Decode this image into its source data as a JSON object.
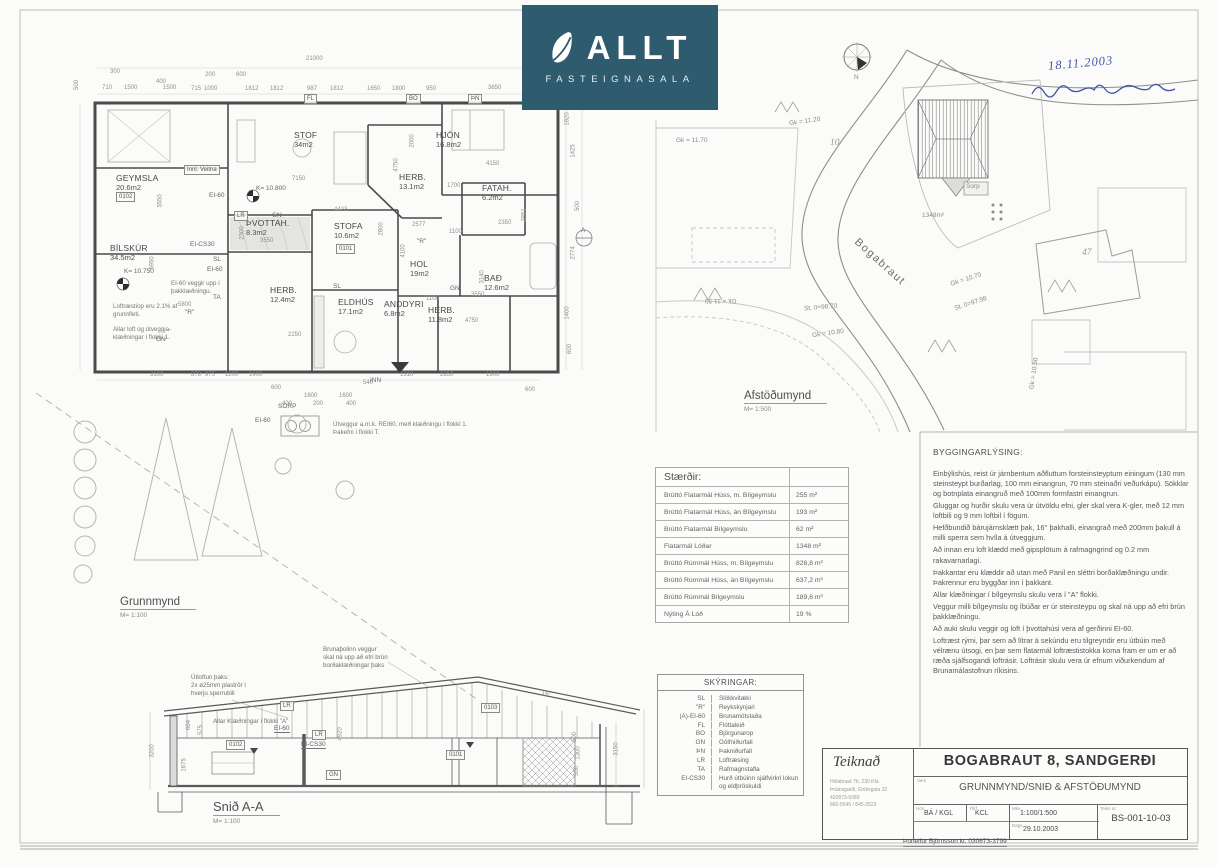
{
  "logo": {
    "brand": "ALLT",
    "subtitle": "FASTEIGNASALA",
    "bg_color": "#2e5b6d",
    "icon": "leaf-icon"
  },
  "handwriting": {
    "date": "18.11.2003",
    "ink_color": "#4356a6"
  },
  "views": {
    "plan": {
      "label": "Grunnmynd",
      "scale": "M= 1:100"
    },
    "site": {
      "label": "Afstöðumynd",
      "scale": "M= 1:500"
    },
    "section": {
      "label": "Snið A-A",
      "scale": "M= 1:100"
    }
  },
  "floor_plan": {
    "rooms": [
      {
        "name": "GEYMSLA",
        "area": "20.6m2",
        "x": 116,
        "y": 174
      },
      {
        "name": "BÍLSKÚR",
        "area": "34.5m2",
        "x": 110,
        "y": 244
      },
      {
        "name": "STOF",
        "area": "34m2",
        "x": 294,
        "y": 131
      },
      {
        "name": "HJÓN",
        "area": "16.8m2",
        "x": 436,
        "y": 131
      },
      {
        "name": "HERB.",
        "area": "13.1m2",
        "x": 399,
        "y": 173
      },
      {
        "name": "FATAH.",
        "area": "6.2m2",
        "x": 482,
        "y": 184
      },
      {
        "name": "STOFA",
        "area": "10.6m2",
        "x": 334,
        "y": 222
      },
      {
        "name": "HOL",
        "area": "19m2",
        "x": 410,
        "y": 260
      },
      {
        "name": "BAÐ",
        "area": "12.6m2",
        "x": 484,
        "y": 274
      },
      {
        "name": "HERB.",
        "area": "12.4m2",
        "x": 270,
        "y": 286
      },
      {
        "name": "ELDHÚS",
        "area": "17.1m2",
        "x": 338,
        "y": 298
      },
      {
        "name": "ANDDYRI",
        "area": "6.8m2",
        "x": 384,
        "y": 300
      },
      {
        "name": "HERB.",
        "area": "11.8m2",
        "x": 428,
        "y": 306
      },
      {
        "name": "ÞVOTTAH.",
        "area": "8.3m2",
        "x": 246,
        "y": 219
      }
    ],
    "dims": [
      {
        "t": "21000",
        "x": 306,
        "y": 56
      },
      {
        "t": "300",
        "x": 110,
        "y": 69
      },
      {
        "t": "400",
        "x": 156,
        "y": 79
      },
      {
        "t": "200",
        "x": 205,
        "y": 72
      },
      {
        "t": "600",
        "x": 236,
        "y": 72
      },
      {
        "t": "710",
        "x": 102,
        "y": 85
      },
      {
        "t": "1500",
        "x": 124,
        "y": 85
      },
      {
        "t": "1500",
        "x": 163,
        "y": 85
      },
      {
        "t": "715",
        "x": 191,
        "y": 86
      },
      {
        "t": "1000",
        "x": 204,
        "y": 86
      },
      {
        "t": "1812",
        "x": 245,
        "y": 86
      },
      {
        "t": "1812",
        "x": 270,
        "y": 86
      },
      {
        "t": "987",
        "x": 307,
        "y": 86
      },
      {
        "t": "1812",
        "x": 330,
        "y": 86
      },
      {
        "t": "1650",
        "x": 367,
        "y": 86
      },
      {
        "t": "1800",
        "x": 392,
        "y": 86
      },
      {
        "t": "950",
        "x": 426,
        "y": 86
      },
      {
        "t": "3650",
        "x": 488,
        "y": 85
      },
      {
        "t": "500",
        "x": 72,
        "y": 82,
        "r": -90
      },
      {
        "t": "3550",
        "x": 154,
        "y": 198,
        "r": -90
      },
      {
        "t": "5950",
        "x": 146,
        "y": 260,
        "r": -90
      },
      {
        "t": "7150",
        "x": 292,
        "y": 176
      },
      {
        "t": "4423",
        "x": 334,
        "y": 207
      },
      {
        "t": "2000",
        "x": 406,
        "y": 138,
        "r": -90
      },
      {
        "t": "4750",
        "x": 390,
        "y": 162,
        "r": -90
      },
      {
        "t": "4150",
        "x": 486,
        "y": 161
      },
      {
        "t": "1700",
        "x": 447,
        "y": 183
      },
      {
        "t": "2350",
        "x": 498,
        "y": 220
      },
      {
        "t": "2851",
        "x": 518,
        "y": 212,
        "r": -90
      },
      {
        "t": "2577",
        "x": 412,
        "y": 222
      },
      {
        "t": "1100",
        "x": 449,
        "y": 229
      },
      {
        "t": "2800",
        "x": 375,
        "y": 226,
        "r": -90
      },
      {
        "t": "4100",
        "x": 397,
        "y": 248,
        "r": -90
      },
      {
        "t": "3140",
        "x": 476,
        "y": 274,
        "r": -90
      },
      {
        "t": "3550",
        "x": 471,
        "y": 292
      },
      {
        "t": "1100",
        "x": 426,
        "y": 296
      },
      {
        "t": "4750",
        "x": 465,
        "y": 318
      },
      {
        "t": "2250",
        "x": 288,
        "y": 332
      },
      {
        "t": "2300",
        "x": 236,
        "y": 230,
        "r": -90
      },
      {
        "t": "3550",
        "x": 260,
        "y": 238
      },
      {
        "t": "5800",
        "x": 178,
        "y": 302
      },
      {
        "t": "3100",
        "x": 150,
        "y": 372
      },
      {
        "t": "878",
        "x": 191,
        "y": 372
      },
      {
        "t": "975",
        "x": 205,
        "y": 372
      },
      {
        "t": "1200",
        "x": 225,
        "y": 372
      },
      {
        "t": "1900",
        "x": 249,
        "y": 372
      },
      {
        "t": "600",
        "x": 271,
        "y": 385
      },
      {
        "t": "540",
        "x": 363,
        "y": 380
      },
      {
        "t": "1310",
        "x": 400,
        "y": 372
      },
      {
        "t": "2850",
        "x": 440,
        "y": 372
      },
      {
        "t": "1900",
        "x": 486,
        "y": 372
      },
      {
        "t": "600",
        "x": 525,
        "y": 387
      },
      {
        "t": "400",
        "x": 282,
        "y": 401
      },
      {
        "t": "1600",
        "x": 304,
        "y": 393
      },
      {
        "t": "1600",
        "x": 339,
        "y": 393
      },
      {
        "t": "200",
        "x": 313,
        "y": 401
      },
      {
        "t": "400",
        "x": 346,
        "y": 401
      },
      {
        "t": "1820",
        "x": 561,
        "y": 116,
        "r": -90
      },
      {
        "t": "1425",
        "x": 567,
        "y": 148,
        "r": -90
      },
      {
        "t": "500",
        "x": 573,
        "y": 203,
        "r": -90
      },
      {
        "t": "2774",
        "x": 567,
        "y": 250,
        "r": -90
      },
      {
        "t": "1400",
        "x": 561,
        "y": 310,
        "r": -90
      },
      {
        "t": "600",
        "x": 565,
        "y": 346,
        "r": -90
      }
    ],
    "codes": [
      {
        "t": "EI-60",
        "x": 209,
        "y": 192
      },
      {
        "t": "K= 10.800",
        "x": 256,
        "y": 185
      },
      {
        "t": "K= 10.750",
        "x": 124,
        "y": 268
      },
      {
        "t": "EI-CS30",
        "x": 190,
        "y": 241
      },
      {
        "t": "SL",
        "x": 213,
        "y": 256
      },
      {
        "t": "EI-60",
        "x": 207,
        "y": 266
      },
      {
        "t": "TA",
        "x": 213,
        "y": 294
      },
      {
        "t": "\"R\"",
        "x": 185,
        "y": 309
      },
      {
        "t": "\"R\"",
        "x": 417,
        "y": 238
      },
      {
        "t": "GN",
        "x": 272,
        "y": 212
      },
      {
        "t": "GN",
        "x": 450,
        "y": 285
      },
      {
        "t": "GN",
        "x": 156,
        "y": 336
      },
      {
        "t": "SL",
        "x": 333,
        "y": 283
      },
      {
        "t": "SORP",
        "x": 278,
        "y": 403
      },
      {
        "t": "EI-60",
        "x": 255,
        "y": 417
      },
      {
        "t": "INN",
        "x": 370,
        "y": 377
      },
      {
        "t": "A",
        "x": 581,
        "y": 227
      }
    ],
    "chips": [
      {
        "t": "Innl. Veitna",
        "x": 184,
        "y": 165
      },
      {
        "t": "LR",
        "x": 234,
        "y": 211
      },
      {
        "t": "0102",
        "x": 116,
        "y": 192
      },
      {
        "t": "0101",
        "x": 336,
        "y": 244
      },
      {
        "t": "FL",
        "x": 304,
        "y": 94
      },
      {
        "t": "BO",
        "x": 406,
        "y": 94
      },
      {
        "t": "ÞN",
        "x": 468,
        "y": 94
      }
    ],
    "notes": [
      {
        "t": "EI-60 veggir upp í\nþakklæðningu.",
        "x": 171,
        "y": 280
      },
      {
        "t": "Loftræstiop eru 2.1% af\ngrunnfleti.",
        "x": 113,
        "y": 303
      },
      {
        "t": "Allar loft og útveggja-\nklæðningar í flokki 1.",
        "x": 113,
        "y": 326
      },
      {
        "t": "Útveggur a.m.k. REI60, með klæðningu í flokki 1.\nÞakefni í flokki T.",
        "x": 333,
        "y": 421
      }
    ]
  },
  "site_plan": {
    "street": "Bogabraut",
    "labels": [
      {
        "t": "Gk = 11.70",
        "x": 676,
        "y": 137
      },
      {
        "t": "Gk = 11.20",
        "x": 789,
        "y": 118,
        "r": -8
      },
      {
        "t": "Gk = 11.30",
        "x": 705,
        "y": 297,
        "r": 180
      },
      {
        "t": "St. 0=98.70",
        "x": 804,
        "y": 304,
        "r": -5
      },
      {
        "t": "Gk = 10.80",
        "x": 812,
        "y": 330,
        "r": -8
      },
      {
        "t": "Sorp",
        "x": 966,
        "y": 183
      },
      {
        "t": "1348m²",
        "x": 922,
        "y": 212
      },
      {
        "t": "Gk = 10.70",
        "x": 950,
        "y": 276,
        "r": -18
      },
      {
        "t": "St. 0=97.98",
        "x": 954,
        "y": 300,
        "r": -18
      },
      {
        "t": "Gk = 10.50",
        "x": 1018,
        "y": 370,
        "r": -82
      },
      {
        "t": "N",
        "x": 854,
        "y": 74
      }
    ],
    "plot_numbers": [
      {
        "t": "10",
        "x": 830,
        "y": 138
      },
      {
        "t": "47",
        "x": 1082,
        "y": 248
      }
    ]
  },
  "section": {
    "dims": [
      {
        "t": "3200",
        "x": 146,
        "y": 748,
        "r": -90
      },
      {
        "t": "664",
        "x": 184,
        "y": 722,
        "r": -90
      },
      {
        "t": "575",
        "x": 196,
        "y": 727,
        "r": -90
      },
      {
        "t": "1675",
        "x": 178,
        "y": 762,
        "r": -90
      },
      {
        "t": "4920",
        "x": 334,
        "y": 731,
        "r": -90
      },
      {
        "t": "500",
        "x": 570,
        "y": 734,
        "r": -90
      },
      {
        "t": "1300",
        "x": 572,
        "y": 750,
        "r": -90
      },
      {
        "t": "500",
        "x": 572,
        "y": 768,
        "r": -90
      },
      {
        "t": "3150",
        "x": 610,
        "y": 746,
        "r": -90
      },
      {
        "t": "16°",
        "x": 542,
        "y": 692
      }
    ],
    "chips": [
      {
        "t": "LR",
        "x": 280,
        "y": 701
      },
      {
        "t": "LR",
        "x": 312,
        "y": 730
      },
      {
        "t": "GN",
        "x": 326,
        "y": 770
      },
      {
        "t": "0102",
        "x": 226,
        "y": 740
      },
      {
        "t": "0101",
        "x": 446,
        "y": 750
      },
      {
        "t": "0103",
        "x": 481,
        "y": 703
      }
    ],
    "underlined": [
      {
        "t": "EI-60",
        "x": 274,
        "y": 725
      },
      {
        "t": "EI-CS30",
        "x": 301,
        "y": 741
      }
    ],
    "notes": [
      {
        "t": "Útloftun þaks:\n2x ø25mm plaströr í\nhverju sperrubili",
        "x": 191,
        "y": 674
      },
      {
        "t": "Brunaþolinn veggur\nskal ná upp að efri brún\nborðaklæðningar þaks",
        "x": 323,
        "y": 646
      },
      {
        "t": "Allar Klæðningar í flokki \"A\"",
        "x": 213,
        "y": 718
      }
    ]
  },
  "size_table": {
    "title": "Stærðir:",
    "rows": [
      {
        "label": "Brúttó Flatarmál Húss, m. Bílgeymslu",
        "value": "255 m²"
      },
      {
        "label": "Brúttó Flatarmál Húss, án Bílgeymslu",
        "value": "193 m²"
      },
      {
        "label": "Brúttó Flatarmál Bílgeymslu",
        "value": "62 m²"
      },
      {
        "label": "Flatarmál Lóðar",
        "value": "1348 m²"
      },
      {
        "label": "Brúttó Rúmmál Húss, m. Bílgeymslu",
        "value": "826,8 m³"
      },
      {
        "label": "Brúttó Rúmmál Húss, án Bílgeymslu",
        "value": "637,2 m³"
      },
      {
        "label": "Brúttó Rúmmál Bílgeymslu",
        "value": "189,6 m³"
      },
      {
        "label": "Nýting Á Lóð",
        "value": "19 %"
      }
    ]
  },
  "legend": {
    "title": "SKÝRINGAR:",
    "rows": [
      {
        "code": "SL",
        "meaning": "Slökkvitæki"
      },
      {
        "code": "\"R\"",
        "meaning": "Reykskynjari"
      },
      {
        "code": "(A)-EI-60",
        "meaning": "Brunamótstaða"
      },
      {
        "code": "FL",
        "meaning": "Flóttaleið"
      },
      {
        "code": "BO",
        "meaning": "Björgunarop"
      },
      {
        "code": "GN",
        "meaning": "Gólfniðurfall"
      },
      {
        "code": "ÞN",
        "meaning": "Þakniðurfall"
      },
      {
        "code": "LR",
        "meaning": "Loftræsing"
      },
      {
        "code": "TA",
        "meaning": "Rafmagnstafla"
      },
      {
        "code": "EI-CS30",
        "meaning": "Hurð útbúinn sjálfvirkri lokun og eldþröskuldi"
      }
    ]
  },
  "description": {
    "title": "BYGGINGARLÝSING:",
    "paragraphs": [
      {
        "t": "Einbýlishús, reist úr járnbentum aðfluttum forsteinsteyptum einingum (130 mm steinsteypt burðarlag, 100 mm einangrun, 70 mm steinaðri veðurkápu).  Sökklar og botnplata einangruð með 100mm formfastri einangrun."
      },
      {
        "t": "Gluggar og hurðir skulu vera úr útvöldu efni, gler skal vera K-gler, með 12 mm loftbili og 9 mm loftbil í fögum."
      },
      {
        "t": "Hefðbundið bárujárnsklætt þak, 16° þakhalli, einangrað með 200mm þakull á milli sperra sem hvíla á útveggjum."
      },
      {
        "t": "Að innan eru loft klædd með gipsplötum á rafmagngrind og 0.2 mm rakavarnarlagi."
      },
      {
        "t": "Þakkantar eru klæddir að utan með Panil en sléttri borðaklæðningu undir. Þakrennur eru byggðar inn í þakkant."
      },
      {
        "t": "Allar klæðningar í bílgeymslu skulu vera í \"A\" flokki."
      },
      {
        "t": "Veggur milli bílgeymslu og íbúðar er úr steinsteypu og skal ná upp að efri brún þakklæðningu."
      },
      {
        "t": "Að auki skulu veggir og loft í þvottahúsi vera af gerðinni EI-60."
      },
      {
        "t": "Loftræst rými, þar sem að lítrar á sekúndu eru tilgreyndir eru útbúin með vélrænu útsogi, en þar sem flatarmál loftræstistokka koma fram er um er að ræða sjálfsogandi loftrásir.  Loftrásir skulu vera úr efnum viðurkendum af Brunamálastofnun ríkisins."
      }
    ]
  },
  "title_block": {
    "drawn_label": "Teiknað",
    "address_lines": [
      {
        "t": "Hólabraut 7b, 230 Kfa"
      },
      {
        "t": "Þráinsgarði, Eiríksgata 32"
      },
      {
        "t": "420873-5089"
      },
      {
        "t": "860-5545 / 845-3523"
      }
    ],
    "verk_label": "Verk",
    "project_title": "BOGABRAUT 8, SANDGERÐI",
    "sheet_title": "GRUNNMYND/SNIÐ & AFSTÖÐUMYND",
    "hon_label": "Hön.",
    "drawn_by": "BÁ / KGL",
    "yfirf_label": "Yfirf.",
    "checked_by": "KCL",
    "mkv_label": "Mkv.",
    "scales": "1:100/1:500",
    "dags_label": "Dags.",
    "date": "29.10.2003",
    "no_label": "Teikn nr.",
    "drawing_no": "BS-001-10-03",
    "certifier": "Þorleifur Björnsson  kt. 030673-3799"
  }
}
